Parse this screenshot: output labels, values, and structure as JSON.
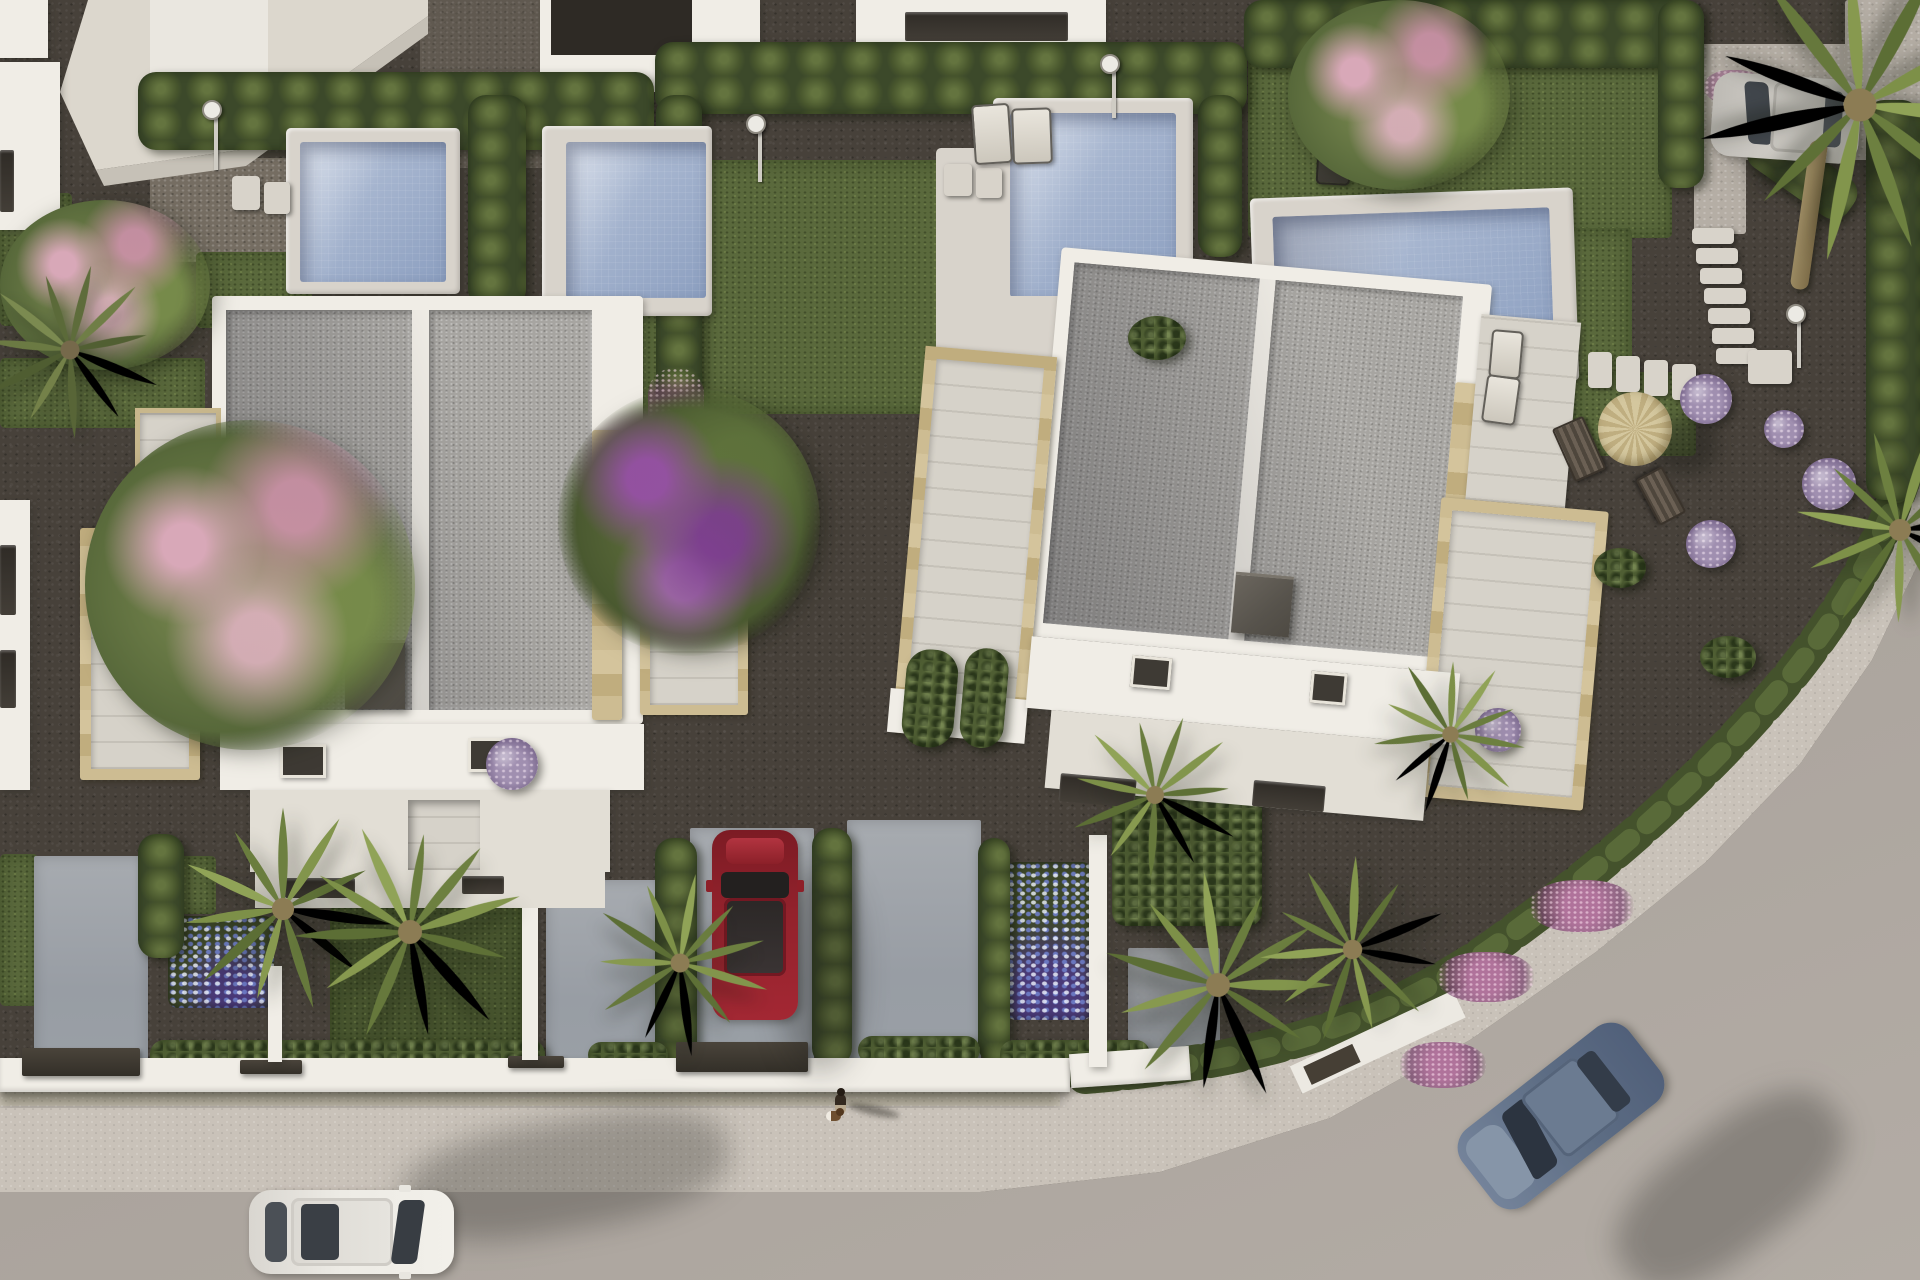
{
  "scene": {
    "type": "3d-architectural-aerial-render",
    "description": "Top-down aerial 3D rendering of a modern residential development at golden hour: two large white flat-roofed villas with travertine-trimmed pergolas, four private swimming pools, landscaped gravel gardens with lawns, hedges, palm trees and flowering shrubs, fronted by a light gray street that curves around a corner plot. A white car and a blue car drive on the road, a red car and a silver car are parked in driveways, and a pedestrian walks a small dog on the sidewalk.",
    "time_of_day": "late afternoon, long soft shadows",
    "camera": "bird's-eye (near-orthographic) view"
  },
  "palette": {
    "gravel": "#47413a",
    "gravelLight": "#756d62",
    "road": "#b0a9a2",
    "roadDark": "#a29b94",
    "walk": "#c9c2b9",
    "grass": "#5a693c",
    "grassDark": "#47542e",
    "hedge": "#4f5e33",
    "hedgeDark": "#3c4928",
    "white": "#f0ede6",
    "whiteDim": "#e2ded5",
    "roof": "#a7a5a1",
    "stone": "#c8b78c",
    "deck": "#d6d2c9",
    "water": "#9fb0cb",
    "coping": "#d8d3cb",
    "chimney": "#5e5952",
    "dark": "#37332d",
    "pink": "#b98ba1",
    "purple": "#8a5f9e",
    "lilac": "#a08fb0",
    "palmGreen": "#7d8f4b",
    "carRed": "#8e2028",
    "carBlue": "#5d6d83",
    "carSilver": "#c8c5bf",
    "carWhite": "#ebe9e3"
  },
  "inventory": {
    "villas": 2,
    "partial_neighbor_buildings": 5,
    "pools": 4,
    "cars": [
      "white hatchback driving on street",
      "red coupe parked in driveway",
      "silver hatchback parked at rear driveway",
      "blue-gray sedan driving around the curve"
    ],
    "pedestrians": 1,
    "dogs": 1,
    "palm_trees": 8,
    "flowering_trees": [
      "pink blossom tree (top-left corner)",
      "large pink blossom tree (left of villa 1)",
      "purple bougainvillea (between villas)",
      "pink blossom tree (top right-center)"
    ],
    "sun_loungers": 5,
    "parasol": 1,
    "deck_chairs": 2,
    "outdoor_showers": 4,
    "stepping_stone_paths": 4,
    "street": "two-lane light gray road curving around corner plot with speckled sidewalk and low hedge border",
    "front_boundary": "white rendered walls with dark gate caps and shrubs"
  },
  "aria": {
    "stage": "Aerial rendering of two modern white villas with pools, gardens and a curving street",
    "villa1": "Left villa: flat gray roof with white parapet, stone pergolas and roof terrace",
    "villa2": "Right villa: flat gray roof with white parapet, stone pergolas and roof terrace",
    "street": "Curved street with sidewalk and hedge border",
    "pools": "Four private swimming pools with pale stone coping"
  }
}
